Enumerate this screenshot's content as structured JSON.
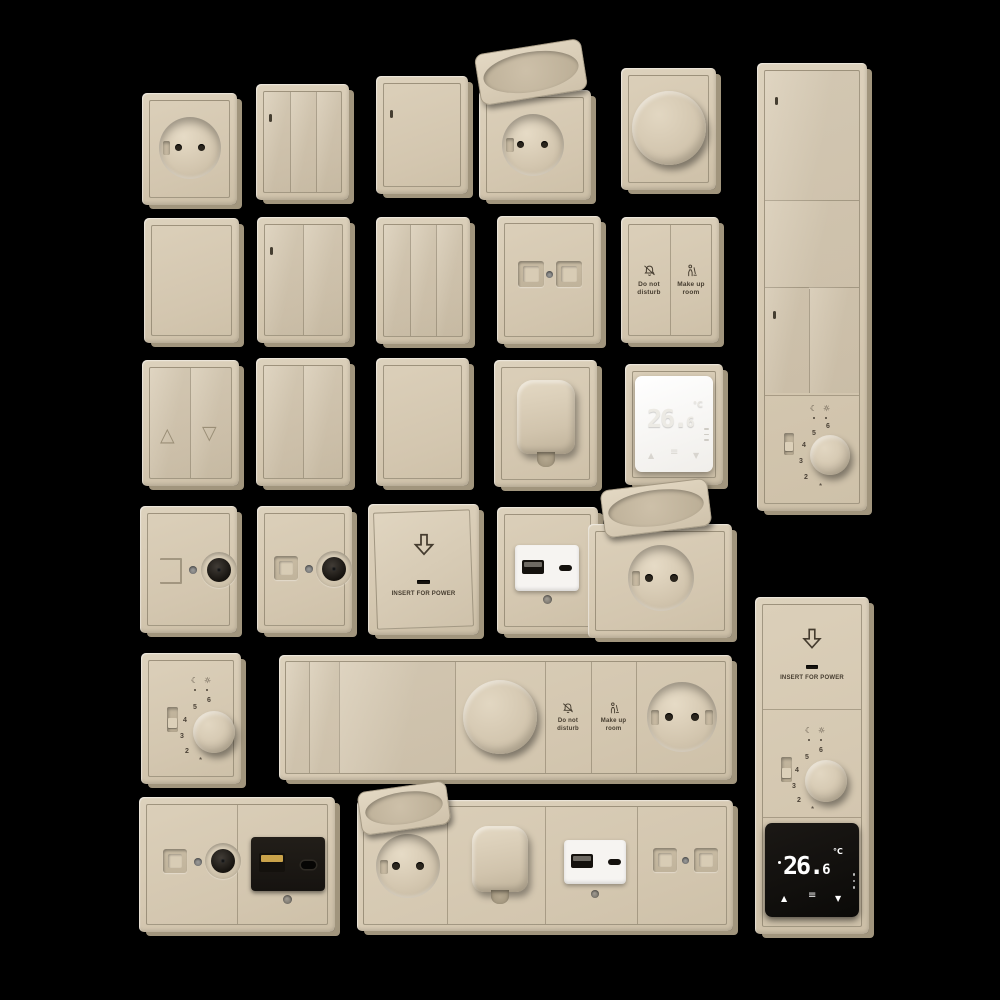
{
  "scene": {
    "background": "#000000",
    "collection": "beige wall switches, sockets and room controls"
  },
  "colors": {
    "plate_beige": "#d6c9b2",
    "plate_highlight": "#ddd2bd",
    "plate_side_shadow": "#a1957d",
    "frame_line": "#60563f",
    "label_ink": "#453c2f",
    "module_white": "#f6f4f1",
    "module_black": "#161310",
    "display_digits_white": "#ffffff",
    "coax_black": "#16130f",
    "metal_grey": "#8d8d8d",
    "usb_gold": "#c9a24a"
  },
  "labels": {
    "do_not_disturb": {
      "line1": "Do not",
      "line2": "disturb"
    },
    "make_up_room": {
      "line1": "Make up",
      "line2": "room"
    },
    "insert_for_power": "INSERT FOR POWER"
  },
  "display": {
    "integer": "26.",
    "fraction": "6",
    "unit": "°C",
    "up": "▲",
    "down": "▼",
    "menu": "≡"
  },
  "dial": {
    "numbers": [
      "2",
      "3",
      "4",
      "5",
      "6"
    ],
    "moon": "☾",
    "sun": "☼",
    "frost": "*"
  },
  "blind": {
    "up": "△",
    "down": "▽"
  }
}
